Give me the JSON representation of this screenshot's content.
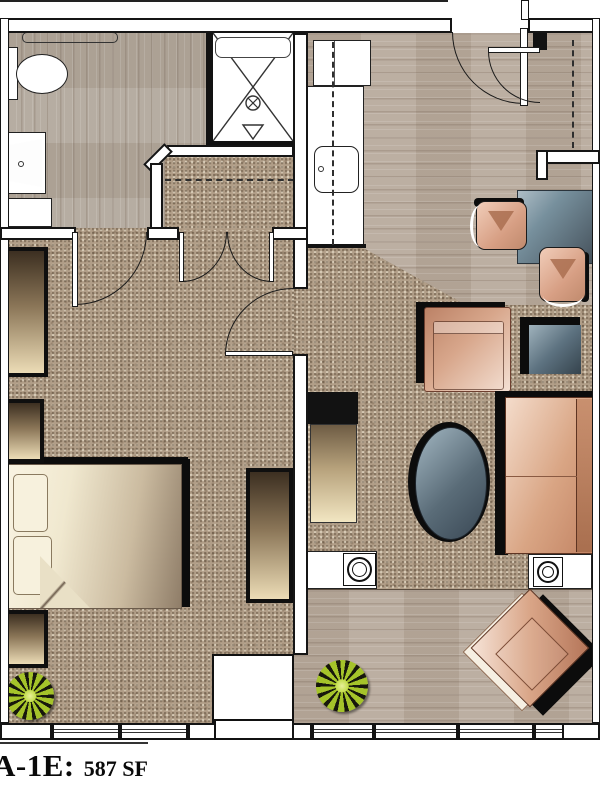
{
  "plan_label": {
    "unit": "A-1E:",
    "area": "587 SF"
  },
  "palette": {
    "wall_line": "#1a1a1a",
    "carpet": "#b19e88",
    "wood_floor": "#b8aa9c",
    "bath_wood_floor": "#b2a89c",
    "upholstery_salmon": "#d79f84",
    "table_top_blue": "#5d707c",
    "bedding_cream": "#f0e8cf",
    "casegoods_dark": "#3c2f21",
    "plant_green": "#a5c32a",
    "shadow": "#0c0c0c"
  },
  "symbols": [
    {
      "name": "entry-door-swing"
    },
    {
      "name": "entry-closet-door-swing"
    },
    {
      "name": "bathroom-door-swing"
    },
    {
      "name": "closet-double-door-swing"
    },
    {
      "name": "bedroom-door-swing"
    },
    {
      "name": "closet-rod-dashed-line"
    },
    {
      "name": "upper-cabinet-dashed-line"
    },
    {
      "name": "toilet"
    },
    {
      "name": "vanity-sink"
    },
    {
      "name": "shower-stall-with-drain"
    },
    {
      "name": "kitchen-sink"
    },
    {
      "name": "refrigerator"
    },
    {
      "name": "kitchen-counter"
    },
    {
      "name": "dining-table"
    },
    {
      "name": "dining-chair"
    },
    {
      "name": "armchair"
    },
    {
      "name": "sofa"
    },
    {
      "name": "accent-chair"
    },
    {
      "name": "coffee-table"
    },
    {
      "name": "side-table"
    },
    {
      "name": "tv-console"
    },
    {
      "name": "bed"
    },
    {
      "name": "dresser"
    },
    {
      "name": "wardrobe"
    },
    {
      "name": "potted-plant"
    },
    {
      "name": "speaker-table"
    },
    {
      "name": "window-band"
    },
    {
      "name": "patio-door"
    }
  ]
}
